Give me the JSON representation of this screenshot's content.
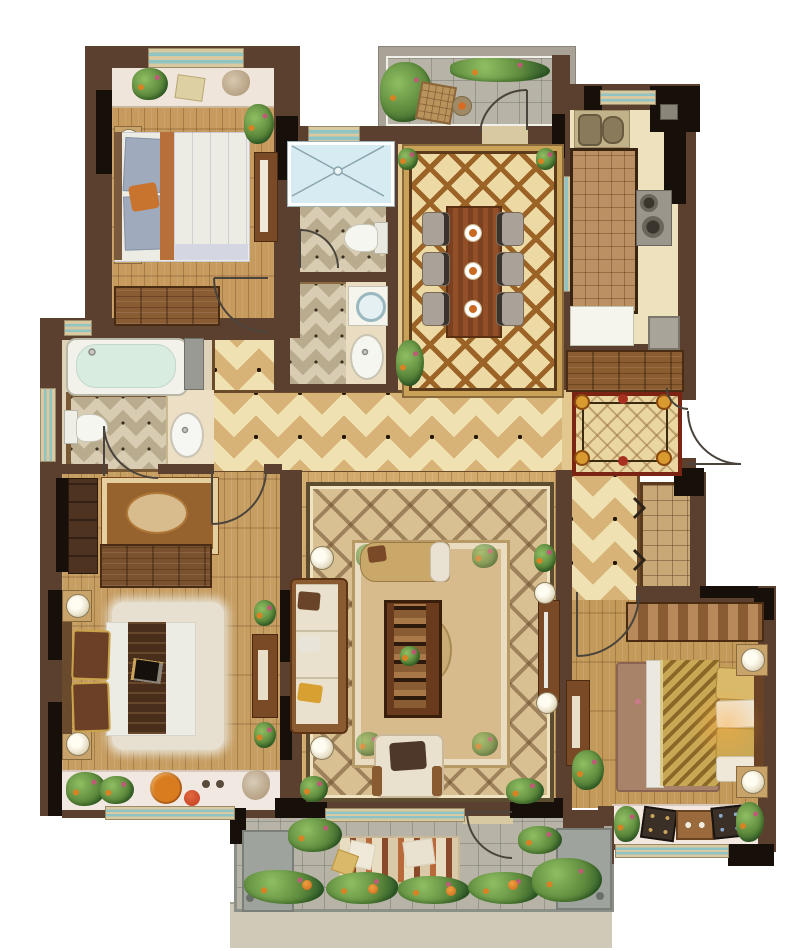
{
  "title": "residential-apartment-floor-plan",
  "canvas": {
    "width": 800,
    "height": 951
  },
  "palette": {
    "outside": "#ffffff",
    "wall": "#5b4030",
    "wall_dark": "#17100a",
    "wall_gray": "#a8a396",
    "window_frame": "#d8c9a0",
    "window_glass": "#8fc3c4",
    "wood_warm": "#c79a5e",
    "wood_light": "#d2ab6c",
    "tile_gold": "#d7b377",
    "tile_cream": "#f0e1b2",
    "tile_bath": "#d6cbb0",
    "kitchen_floor": "#eee1bd",
    "shower_blue": "#d6ecf2",
    "terrace_tile": "#b7b3a6",
    "sill_pink": "#f2e8e2",
    "rug_dining_field": "#ecd9a4",
    "rug_lattice": "#9c6327",
    "rug_master": "#96622e",
    "rug_living": "#d9c093",
    "rug_foyer": "#e9d6a0",
    "rug_foyer_border": "#7c2414",
    "rug_bedroom2": "#a9826a",
    "bed_white": "#ecebe4",
    "bed_gold": "#c9a855",
    "pillow_blue": "#9fabbc",
    "accent_orange": "#c9742e",
    "sofa_cream": "#e9e1cd",
    "table_wood": "#7c4120",
    "plant_green": "#5d8a3c",
    "plant_dark": "#39632e",
    "flower_orange": "#d98224",
    "door_stroke": "#4a443c"
  },
  "rooms": [
    {
      "id": "bedroom-top-left",
      "furniture": [
        "double-bed",
        "nightstands",
        "table-lamps",
        "wardrobe",
        "desk",
        "bay-window-sill",
        "plants"
      ]
    },
    {
      "id": "shower-room",
      "furniture": [
        "shower-tray"
      ]
    },
    {
      "id": "wc",
      "furniture": [
        "toilet"
      ]
    },
    {
      "id": "laundry",
      "furniture": [
        "washing-machine",
        "basin"
      ]
    },
    {
      "id": "dining-room",
      "furniture": [
        "dining-table",
        "six-chairs",
        "place-settings",
        "ornate-rug",
        "plants"
      ]
    },
    {
      "id": "terrace-top",
      "furniture": [
        "square-table",
        "stool",
        "planting"
      ]
    },
    {
      "id": "kitchen",
      "furniture": [
        "double-sink",
        "island-counter",
        "cooktop",
        "refrigerator",
        "appliance"
      ]
    },
    {
      "id": "entry-foyer",
      "furniture": [
        "ornate-rug",
        "entry-door"
      ]
    },
    {
      "id": "hallway",
      "furniture": []
    },
    {
      "id": "bathroom",
      "furniture": [
        "bathtub",
        "toilet",
        "basin",
        "cabinet"
      ]
    },
    {
      "id": "master-bedroom",
      "furniture": [
        "double-bed",
        "nightstands",
        "table-lamps",
        "wardrobe",
        "dressers",
        "medallion-rug",
        "shag-rug",
        "bay-window-sill",
        "plants"
      ]
    },
    {
      "id": "living-room",
      "furniture": [
        "sofa",
        "chaise",
        "armchair",
        "coffee-table",
        "tv-cabinet",
        "floor-lamps",
        "ornate-rug",
        "plants"
      ]
    },
    {
      "id": "corridor",
      "furniture": [
        "closet",
        "sliding-door-marks"
      ]
    },
    {
      "id": "bedroom-bottom-right",
      "furniture": [
        "double-bed",
        "nightstands",
        "wardrobe",
        "dresser",
        "floral-rug",
        "bay-window-sill",
        "plants"
      ]
    },
    {
      "id": "terrace-bottom",
      "furniture": [
        "lounge-mat",
        "cushions",
        "planting",
        "utility-units"
      ]
    }
  ]
}
